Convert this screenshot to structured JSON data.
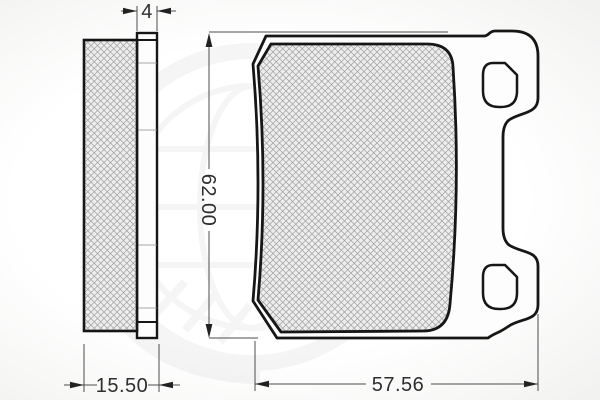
{
  "drawing": {
    "type": "technical-dimension-drawing",
    "subject": "brake-pad",
    "views": {
      "side_view": "side-profile-with-friction-material-and-backplate",
      "front_view": "pad-face-with-backplate-ears-and-two-holes"
    },
    "dimensions": {
      "backplate_thickness": "4",
      "total_thickness": "15.50",
      "height": "62.00",
      "width": "57.56"
    },
    "colors": {
      "outline": "#161616",
      "dimension_line": "#4d4d4d",
      "hatch": "#9c9c9c",
      "material_fill": "#ededed",
      "plate_fill": "#fdfdfd",
      "watermark": "#555555",
      "background": "#fbfbfa"
    }
  }
}
